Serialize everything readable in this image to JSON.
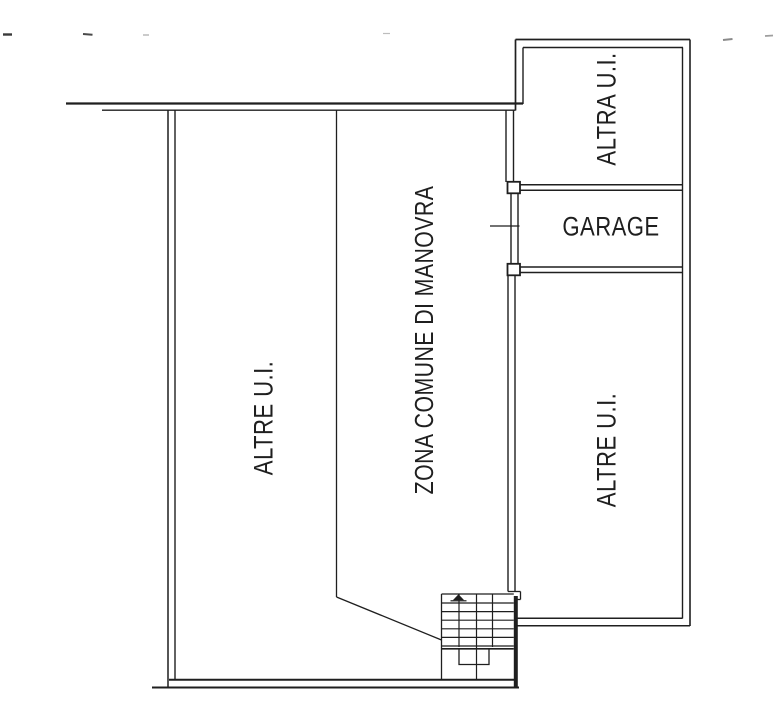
{
  "document": {
    "kind_note": "architectural floor plan scan",
    "colors": {
      "ink": "#1f1f1f",
      "background": "#ffffff"
    }
  },
  "floorplan": {
    "rooms": [
      {
        "name": "left-unit",
        "label": "ALTRE U.I."
      },
      {
        "name": "maneuver-zone",
        "label": "ZONA COMUNE DI MANOVRA"
      },
      {
        "name": "upper-right-unit",
        "label": "ALTRA U.I."
      },
      {
        "name": "garage",
        "label": "GARAGE"
      },
      {
        "name": "lower-right-unit",
        "label": "ALTRE U.I."
      }
    ]
  }
}
